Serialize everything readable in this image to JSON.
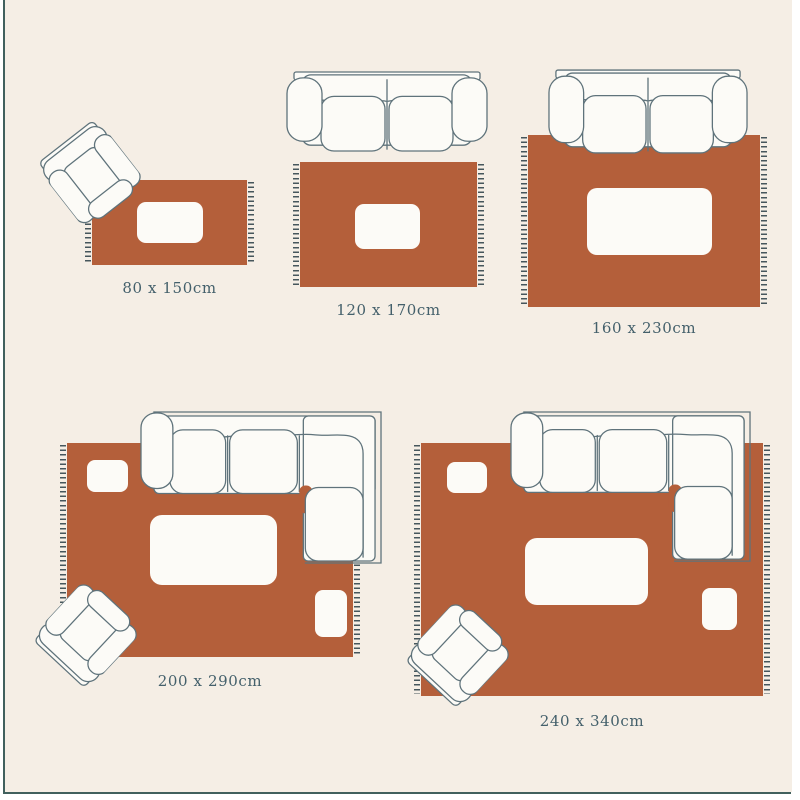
{
  "diagram": {
    "type": "rug-size-guide",
    "scenes": [
      {
        "name": "rug-80x150",
        "label": "80 x 150cm",
        "furniture": [
          "armchair",
          "coffee-table"
        ]
      },
      {
        "name": "rug-120x170",
        "label": "120 x 170cm",
        "furniture": [
          "sofa-2-seat",
          "coffee-table"
        ]
      },
      {
        "name": "rug-160x230",
        "label": "160 x 230cm",
        "furniture": [
          "sofa-2-seat",
          "coffee-table"
        ]
      },
      {
        "name": "rug-200x290",
        "label": "200 x 290cm",
        "furniture": [
          "sectional-sofa",
          "armchair",
          "coffee-table",
          "side-table",
          "side-table"
        ]
      },
      {
        "name": "rug-240x340",
        "label": "240 x 340cm",
        "furniture": [
          "sectional-sofa",
          "armchair",
          "coffee-table",
          "side-table",
          "side-table"
        ]
      }
    ]
  },
  "colors": {
    "background": "#f5eee5",
    "rug": "#b45f3a",
    "fringe": "#46565c",
    "furniture_outline": "#5f737b",
    "furniture_fill": "#fcfbf7",
    "frame_line": "#41605d",
    "label_text": "#44606b"
  }
}
